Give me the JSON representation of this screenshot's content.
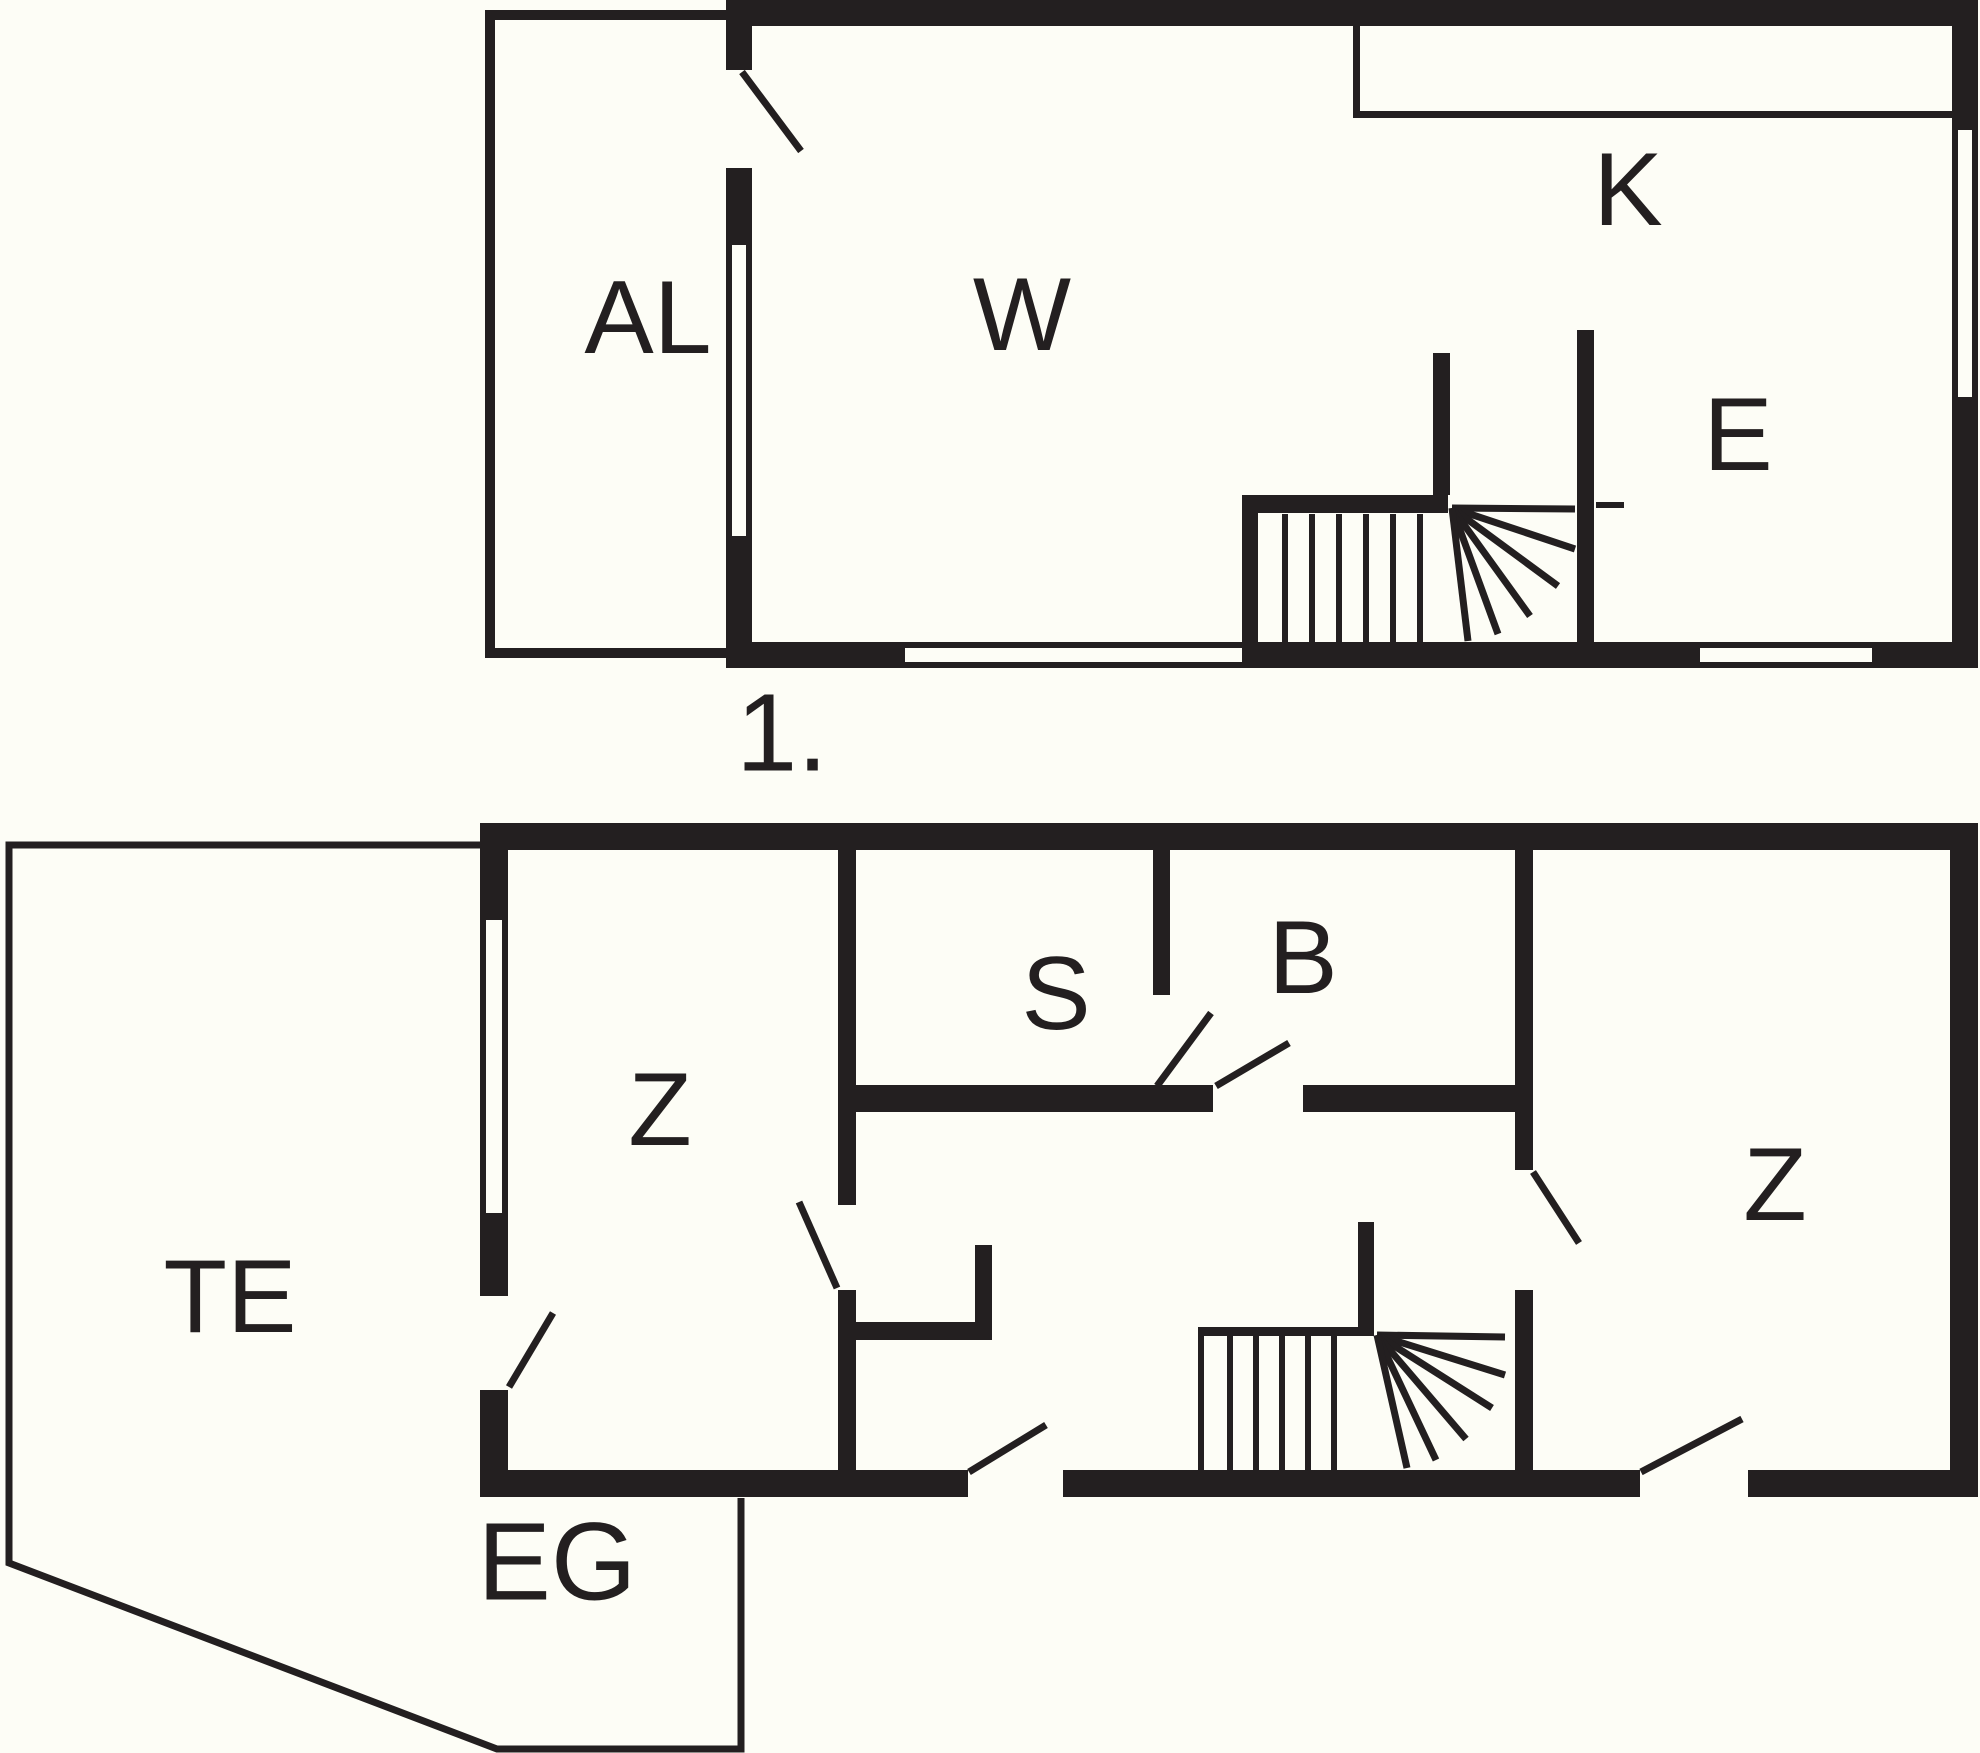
{
  "meta": {
    "type": "architectural-floor-plan",
    "floors": [
      {
        "id": "first-floor",
        "label": "1.",
        "rooms": [
          "AL",
          "W",
          "K",
          "E"
        ]
      },
      {
        "id": "ground-floor",
        "label": "EG",
        "rooms": [
          "TE",
          "Z",
          "S",
          "B",
          "Z"
        ]
      }
    ]
  },
  "colors": {
    "background": "#fdfdf6",
    "ink": "#231f20"
  },
  "canvas": {
    "width": 1980,
    "height": 1753
  },
  "plan": {
    "rects": [
      {
        "n": "u-top-wall",
        "x": 726,
        "y": 0,
        "w": 1252,
        "h": 26
      },
      {
        "n": "u-left-wall-a",
        "x": 726,
        "y": 26,
        "w": 26,
        "h": 44
      },
      {
        "n": "u-left-wall-b",
        "x": 726,
        "y": 168,
        "w": 26,
        "h": 77
      },
      {
        "n": "u-left-wall-c",
        "x": 726,
        "y": 536,
        "w": 26,
        "h": 132
      },
      {
        "n": "u-right-wall-a",
        "x": 1952,
        "y": 26,
        "w": 26,
        "h": 104
      },
      {
        "n": "u-right-wall-b",
        "x": 1952,
        "y": 397,
        "w": 26,
        "h": 271
      },
      {
        "n": "u-bottom-wall-a",
        "x": 726,
        "y": 642,
        "w": 179,
        "h": 26
      },
      {
        "n": "u-bottom-wall-b",
        "x": 1242,
        "y": 642,
        "w": 458,
        "h": 26
      },
      {
        "n": "u-bottom-wall-c",
        "x": 1872,
        "y": 642,
        "w": 106,
        "h": 26
      },
      {
        "n": "u-stair-wall-top",
        "x": 1242,
        "y": 495,
        "w": 206,
        "h": 18
      },
      {
        "n": "u-stair-wall-left",
        "x": 1242,
        "y": 513,
        "w": 16,
        "h": 129
      },
      {
        "n": "u-stair-stub",
        "x": 1433,
        "y": 353,
        "w": 17,
        "h": 142
      },
      {
        "n": "u-e-room-wall",
        "x": 1577,
        "y": 330,
        "w": 17,
        "h": 312
      },
      {
        "n": "al-annex-top",
        "x": 485,
        "y": 10,
        "w": 241,
        "h": 10
      },
      {
        "n": "al-annex-left",
        "x": 485,
        "y": 10,
        "w": 10,
        "h": 648
      },
      {
        "n": "al-annex-bottom",
        "x": 485,
        "y": 648,
        "w": 241,
        "h": 10
      },
      {
        "n": "k-counter-left",
        "x": 1353,
        "y": 26,
        "w": 7,
        "h": 92
      },
      {
        "n": "k-counter-bottom",
        "x": 1353,
        "y": 111,
        "w": 599,
        "h": 7
      },
      {
        "n": "g-top-wall",
        "x": 480,
        "y": 823,
        "w": 1498,
        "h": 27
      },
      {
        "n": "g-left-wall-a",
        "x": 480,
        "y": 850,
        "w": 28,
        "h": 70
      },
      {
        "n": "g-left-wall-b",
        "x": 480,
        "y": 1213,
        "w": 28,
        "h": 83
      },
      {
        "n": "g-left-wall-c",
        "x": 480,
        "y": 1390,
        "w": 28,
        "h": 80
      },
      {
        "n": "g-right-wall",
        "x": 1950,
        "y": 850,
        "w": 28,
        "h": 620
      },
      {
        "n": "g-bottom-wall-a",
        "x": 480,
        "y": 1470,
        "w": 488,
        "h": 27
      },
      {
        "n": "g-bottom-wall-b",
        "x": 1063,
        "y": 1470,
        "w": 577,
        "h": 27
      },
      {
        "n": "g-bottom-wall-c",
        "x": 1748,
        "y": 1470,
        "w": 230,
        "h": 27
      },
      {
        "n": "g-z1-east-wall-a",
        "x": 838,
        "y": 850,
        "w": 18,
        "h": 355
      },
      {
        "n": "g-z1-east-wall-b",
        "x": 838,
        "y": 1290,
        "w": 18,
        "h": 180
      },
      {
        "n": "g-nook-wall",
        "x": 856,
        "y": 1322,
        "w": 136,
        "h": 18
      },
      {
        "n": "g-nook-riser",
        "x": 975,
        "y": 1245,
        "w": 17,
        "h": 95
      },
      {
        "n": "g-sb-divider",
        "x": 1153,
        "y": 850,
        "w": 17,
        "h": 145
      },
      {
        "n": "g-sb-bottom-wall-a",
        "x": 856,
        "y": 1085,
        "w": 357,
        "h": 27
      },
      {
        "n": "g-sb-bottom-wall-b",
        "x": 1303,
        "y": 1085,
        "w": 220,
        "h": 27
      },
      {
        "n": "g-z2-west-wall-a",
        "x": 1515,
        "y": 850,
        "w": 18,
        "h": 320
      },
      {
        "n": "g-z2-west-wall-b",
        "x": 1515,
        "y": 1290,
        "w": 18,
        "h": 180
      },
      {
        "n": "g-stair-stub",
        "x": 1358,
        "y": 1222,
        "w": 16,
        "h": 112
      },
      {
        "n": "g-stair-top-wall",
        "x": 1198,
        "y": 1327,
        "w": 176,
        "h": 9
      },
      {
        "n": "g-stair-left-line",
        "x": 1198,
        "y": 1336,
        "w": 6,
        "h": 134
      }
    ],
    "lines": [
      {
        "n": "u-window-left-face1",
        "x1": 729,
        "y1": 245,
        "x2": 729,
        "y2": 536,
        "s": 6
      },
      {
        "n": "u-window-left-face2",
        "x1": 749,
        "y1": 245,
        "x2": 749,
        "y2": 536,
        "s": 6
      },
      {
        "n": "u-window-right-face1",
        "x1": 1955,
        "y1": 130,
        "x2": 1955,
        "y2": 397,
        "s": 6
      },
      {
        "n": "u-window-right-face2",
        "x1": 1975,
        "y1": 130,
        "x2": 1975,
        "y2": 397,
        "s": 6
      },
      {
        "n": "u-window-bottom1-face1",
        "x1": 905,
        "y1": 645,
        "x2": 1242,
        "y2": 645,
        "s": 6
      },
      {
        "n": "u-window-bottom1-face2",
        "x1": 905,
        "y1": 665,
        "x2": 1242,
        "y2": 665,
        "s": 6
      },
      {
        "n": "u-window-bottom2-face1",
        "x1": 1700,
        "y1": 645,
        "x2": 1872,
        "y2": 645,
        "s": 6
      },
      {
        "n": "u-window-bottom2-face2",
        "x1": 1700,
        "y1": 665,
        "x2": 1872,
        "y2": 665,
        "s": 6
      },
      {
        "n": "g-window-left-face1",
        "x1": 483,
        "y1": 920,
        "x2": 483,
        "y2": 1213,
        "s": 6
      },
      {
        "n": "g-window-left-face2",
        "x1": 505,
        "y1": 920,
        "x2": 505,
        "y2": 1213,
        "s": 6
      },
      {
        "n": "u-tread-1",
        "x1": 1285,
        "y1": 514,
        "x2": 1285,
        "y2": 642,
        "s": 6
      },
      {
        "n": "u-tread-2",
        "x1": 1312,
        "y1": 514,
        "x2": 1312,
        "y2": 642,
        "s": 6
      },
      {
        "n": "u-tread-3",
        "x1": 1339,
        "y1": 514,
        "x2": 1339,
        "y2": 642,
        "s": 6
      },
      {
        "n": "u-tread-4",
        "x1": 1366,
        "y1": 514,
        "x2": 1366,
        "y2": 642,
        "s": 6
      },
      {
        "n": "u-tread-5",
        "x1": 1393,
        "y1": 514,
        "x2": 1393,
        "y2": 642,
        "s": 6
      },
      {
        "n": "u-tread-6",
        "x1": 1420,
        "y1": 514,
        "x2": 1420,
        "y2": 642,
        "s": 6
      },
      {
        "n": "u-winder-1",
        "x1": 1452,
        "y1": 508,
        "x2": 1575,
        "y2": 509,
        "s": 7
      },
      {
        "n": "u-winder-2",
        "x1": 1452,
        "y1": 508,
        "x2": 1575,
        "y2": 549,
        "s": 7
      },
      {
        "n": "u-winder-3",
        "x1": 1452,
        "y1": 508,
        "x2": 1558,
        "y2": 586,
        "s": 7
      },
      {
        "n": "u-winder-4",
        "x1": 1452,
        "y1": 508,
        "x2": 1530,
        "y2": 616,
        "s": 7
      },
      {
        "n": "u-winder-5",
        "x1": 1452,
        "y1": 508,
        "x2": 1498,
        "y2": 634,
        "s": 7
      },
      {
        "n": "u-winder-6",
        "x1": 1452,
        "y1": 508,
        "x2": 1468,
        "y2": 641,
        "s": 7
      },
      {
        "n": "u-landing-line",
        "x1": 1596,
        "y1": 505,
        "x2": 1624,
        "y2": 505,
        "s": 6
      },
      {
        "n": "g-tread-1",
        "x1": 1230,
        "y1": 1336,
        "x2": 1230,
        "y2": 1470,
        "s": 6
      },
      {
        "n": "g-tread-2",
        "x1": 1256,
        "y1": 1336,
        "x2": 1256,
        "y2": 1470,
        "s": 6
      },
      {
        "n": "g-tread-3",
        "x1": 1282,
        "y1": 1336,
        "x2": 1282,
        "y2": 1470,
        "s": 6
      },
      {
        "n": "g-tread-4",
        "x1": 1308,
        "y1": 1336,
        "x2": 1308,
        "y2": 1470,
        "s": 6
      },
      {
        "n": "g-tread-5",
        "x1": 1334,
        "y1": 1336,
        "x2": 1334,
        "y2": 1470,
        "s": 6
      },
      {
        "n": "g-winder-1",
        "x1": 1377,
        "y1": 1335,
        "x2": 1505,
        "y2": 1337,
        "s": 7
      },
      {
        "n": "g-winder-2",
        "x1": 1377,
        "y1": 1335,
        "x2": 1505,
        "y2": 1375,
        "s": 7
      },
      {
        "n": "g-winder-3",
        "x1": 1377,
        "y1": 1335,
        "x2": 1492,
        "y2": 1408,
        "s": 7
      },
      {
        "n": "g-winder-4",
        "x1": 1377,
        "y1": 1335,
        "x2": 1466,
        "y2": 1439,
        "s": 7
      },
      {
        "n": "g-winder-5",
        "x1": 1377,
        "y1": 1335,
        "x2": 1436,
        "y2": 1460,
        "s": 7
      },
      {
        "n": "g-winder-6",
        "x1": 1377,
        "y1": 1335,
        "x2": 1407,
        "y2": 1468,
        "s": 7
      },
      {
        "n": "u-door-swing-al",
        "x1": 742,
        "y1": 72,
        "x2": 801,
        "y2": 151,
        "s": 7
      },
      {
        "n": "g-door-swing-te",
        "x1": 509,
        "y1": 1387,
        "x2": 553,
        "y2": 1313,
        "s": 7
      },
      {
        "n": "g-door-swing-z1",
        "x1": 799,
        "y1": 1202,
        "x2": 837,
        "y2": 1288,
        "s": 7
      },
      {
        "n": "g-door-swing-s",
        "x1": 1157,
        "y1": 1086,
        "x2": 1211,
        "y2": 1013,
        "s": 7
      },
      {
        "n": "g-door-swing-b",
        "x1": 1216,
        "y1": 1086,
        "x2": 1289,
        "y2": 1043,
        "s": 7
      },
      {
        "n": "g-door-swing-entry1",
        "x1": 969,
        "y1": 1472,
        "x2": 1046,
        "y2": 1425,
        "s": 7
      },
      {
        "n": "g-door-swing-entry2",
        "x1": 1641,
        "y1": 1472,
        "x2": 1742,
        "y2": 1419,
        "s": 7
      },
      {
        "n": "g-door-swing-z2",
        "x1": 1533,
        "y1": 1172,
        "x2": 1579,
        "y2": 1243,
        "s": 7
      }
    ],
    "polylines": [
      {
        "n": "te-terrace-outline",
        "s": 7,
        "points": "480,845 9,845 9,1563 497,1749 741,1749 741,1498"
      }
    ],
    "texts": [
      {
        "n": "room-label-al",
        "t": "AL",
        "x": 648,
        "y": 318,
        "fs": 104
      },
      {
        "n": "room-label-w",
        "t": "W",
        "x": 1022,
        "y": 315,
        "fs": 104
      },
      {
        "n": "room-label-k",
        "t": "K",
        "x": 1628,
        "y": 190,
        "fs": 104
      },
      {
        "n": "room-label-e",
        "t": "E",
        "x": 1738,
        "y": 435,
        "fs": 104
      },
      {
        "n": "floor-label-first",
        "t": "1.",
        "x": 782,
        "y": 733,
        "fs": 110
      },
      {
        "n": "room-label-te",
        "t": "TE",
        "x": 230,
        "y": 1297,
        "fs": 104
      },
      {
        "n": "room-label-z1",
        "t": "Z",
        "x": 660,
        "y": 1110,
        "fs": 104
      },
      {
        "n": "room-label-s",
        "t": "S",
        "x": 1056,
        "y": 994,
        "fs": 104
      },
      {
        "n": "room-label-b",
        "t": "B",
        "x": 1303,
        "y": 958,
        "fs": 104
      },
      {
        "n": "room-label-z2",
        "t": "Z",
        "x": 1775,
        "y": 1185,
        "fs": 104
      },
      {
        "n": "floor-label-ground",
        "t": "EG",
        "x": 557,
        "y": 1562,
        "fs": 110
      }
    ]
  }
}
